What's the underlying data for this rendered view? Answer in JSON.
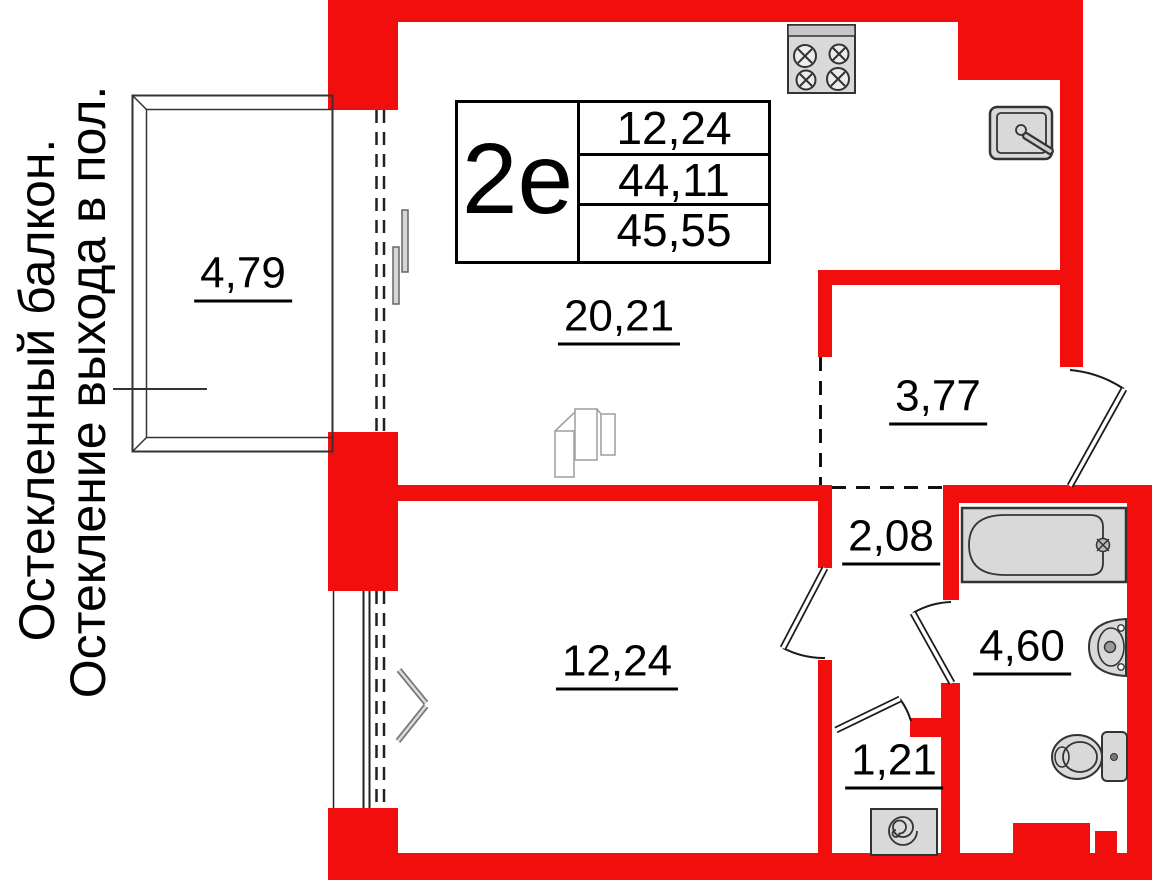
{
  "side_notes": {
    "line1": "Остекленный балкон.",
    "line2": "Остекление выхода в пол."
  },
  "unit": {
    "label": "2е",
    "values": [
      "12,24",
      "44,11",
      "45,55"
    ]
  },
  "rooms": {
    "kitchen_living": "20,21",
    "hallway": "3,77",
    "corridor": "2,08",
    "bedroom": "12,24",
    "laundry": "1,21",
    "bathroom": "4,60",
    "balcony": "4,79"
  },
  "icons": [
    "stove-icon",
    "kitchen-sink-icon",
    "bathtub-icon",
    "washbasin-icon",
    "toilet-icon",
    "washing-machine-icon",
    "wardrobe-icon",
    "door-swing-icon",
    "window-dashed-line",
    "balcony-outline"
  ],
  "colors": {
    "wall": "#f30e0e",
    "fixture_fill": "#d9d9d9",
    "outline": "#333333",
    "text": "#000000"
  }
}
